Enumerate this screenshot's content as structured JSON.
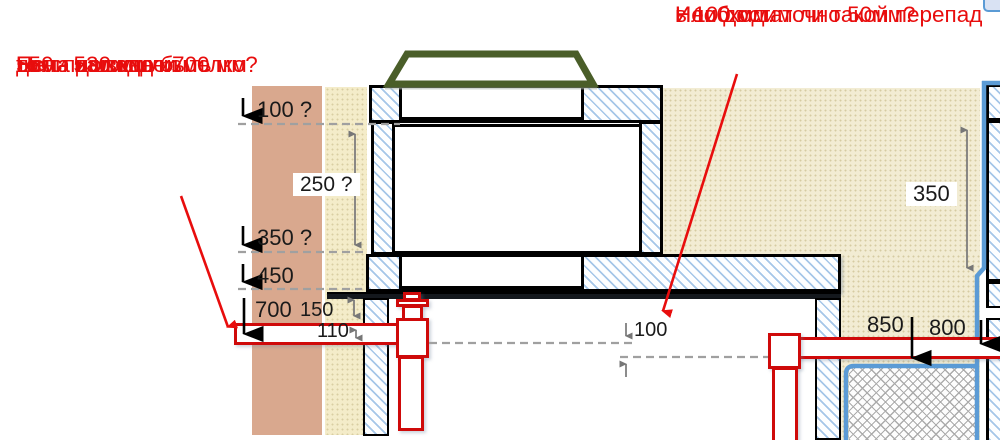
{
  "notes": {
    "left": {
      "lines": [
        "Если на входе 700 мм",
        "то на выходе из",
        "дома должно быть",
        "550 - 530 мм",
        "Не слишком ли мелко?"
      ]
    },
    "top_right": {
      "lines": [
        "Необходим ли такой перепад",
        "в 100 мм.",
        "Или достаточно 50мм?"
      ]
    }
  },
  "dimensions": {
    "depth_100q": "100 ?",
    "height_250q": "250 ?",
    "depth_350q": "350 ?",
    "depth_450": "450",
    "depth_700": "700",
    "gap_150": "150",
    "pipe_110": "110",
    "drop_100": "100",
    "depth_850": "850",
    "depth_800": "800",
    "height_350": "350"
  },
  "colors": {
    "annotation_red": "#e80d0d",
    "pipe_red": "#cf0a0a",
    "hatch_blue": "#a5c6e8",
    "liner_blue": "#5b9bd5",
    "wall_brown": "#d9a88e",
    "soil_beige": "#f2ecd3",
    "lid_green": "#4a5e29",
    "dim_text": "#1a1a1a"
  }
}
